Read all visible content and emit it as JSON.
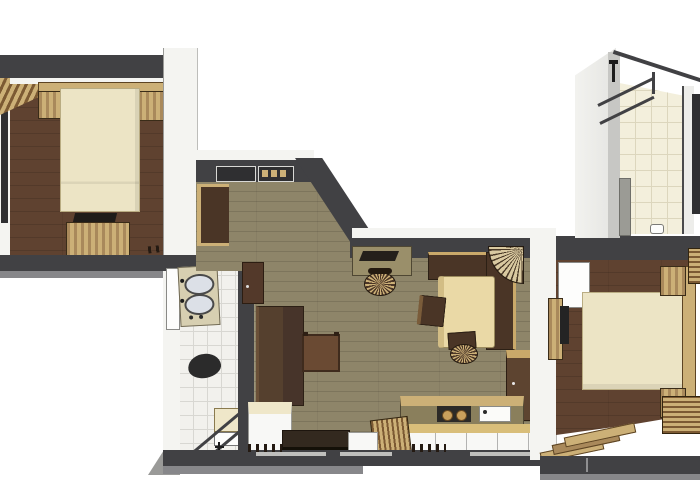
{
  "scene": {
    "type": "3d-floor-plan-render",
    "description": "Top-down 3D rendered apartment floor plan, no text labels",
    "rooms": [
      {
        "id": "bedroom-1",
        "area": "top-left",
        "floor": "brown-planks",
        "furniture": [
          "double-bed",
          "headboard",
          "nightstand-left",
          "nightstand-right",
          "dresser",
          "tv",
          "window",
          "louver-blinds"
        ]
      },
      {
        "id": "bathroom-1",
        "area": "bottom-left-center",
        "floor": "white-tile",
        "furniture": [
          "double-sink-vanity",
          "door-leaf",
          "toilet",
          "shower-glass",
          "shower-mat",
          "faucet"
        ]
      },
      {
        "id": "hallway",
        "area": "center-top",
        "floor": "olive-planks",
        "furniture": [
          "wall-niche-1",
          "wall-niche-2",
          "shelf",
          "wall-cabinet",
          "wardrobe",
          "cream-cabinet",
          "ottoman"
        ]
      },
      {
        "id": "living-dining-room",
        "area": "center",
        "floor": "olive-planks",
        "furniture": [
          "desk",
          "laptop",
          "desk-chair",
          "corner-bench",
          "corner-fan-unit",
          "dining-table",
          "chair-left",
          "chair-bottom",
          "side-cabinet",
          "tv-bench",
          "small-cabinet",
          "slat-bench",
          "kitchen-counter",
          "cooktop",
          "kitchen-sink",
          "kitchen-cabinets",
          "radiators"
        ]
      },
      {
        "id": "bedroom-2",
        "area": "right",
        "floor": "brown-planks",
        "furniture": [
          "double-bed",
          "headboard",
          "nightstand-top",
          "nightstand-bottom",
          "tv",
          "sideboard",
          "door-leaf",
          "radiator-top",
          "radiator-bottom",
          "wooden-steps"
        ]
      },
      {
        "id": "bathroom-2",
        "area": "top-right",
        "floor": "cream-tile",
        "furniture": [
          "shower-glass",
          "shower-fixture",
          "gray-cabinet",
          "wall-unit",
          "floor-fixture"
        ]
      }
    ]
  },
  "palette": {
    "bg": "#ffffff",
    "wall-cut": "#414144",
    "wall-cut-dark": "#2f2f31",
    "wall-face": "#f4f4f1",
    "wall-face-shade": "#c9c9c6",
    "wall-face-mid": "#87878a",
    "floor-brown": "#5f4230",
    "floor-olive": "#8e8569",
    "tile-white": "#f2f1ed",
    "tile-white-line": "#d8d7d2",
    "tile-cream": "#f3efdc",
    "tile-cream-line": "#dcd6bd",
    "linen": "#ece4c5",
    "linen-edge": "#b9ac82",
    "wood-tan": "#ccb077",
    "wood-mid": "#a9895b",
    "wood-dark": "#7c5a33",
    "furn-dark": "#4a3526",
    "furn-dark-edge": "#2c2015",
    "brown-box": "#6a4a33",
    "cream-top": "#efe7c9",
    "white-front": "#f8f8f6",
    "appliance": "#2c2a27",
    "toilet": "#2b2b2b",
    "basin": "#dce0e7",
    "counter-beige": "#d7cfb1",
    "gray-cab": "#9b9b95",
    "desk-olive": "#9a8f6a",
    "table-cream": "#ead9a6"
  }
}
